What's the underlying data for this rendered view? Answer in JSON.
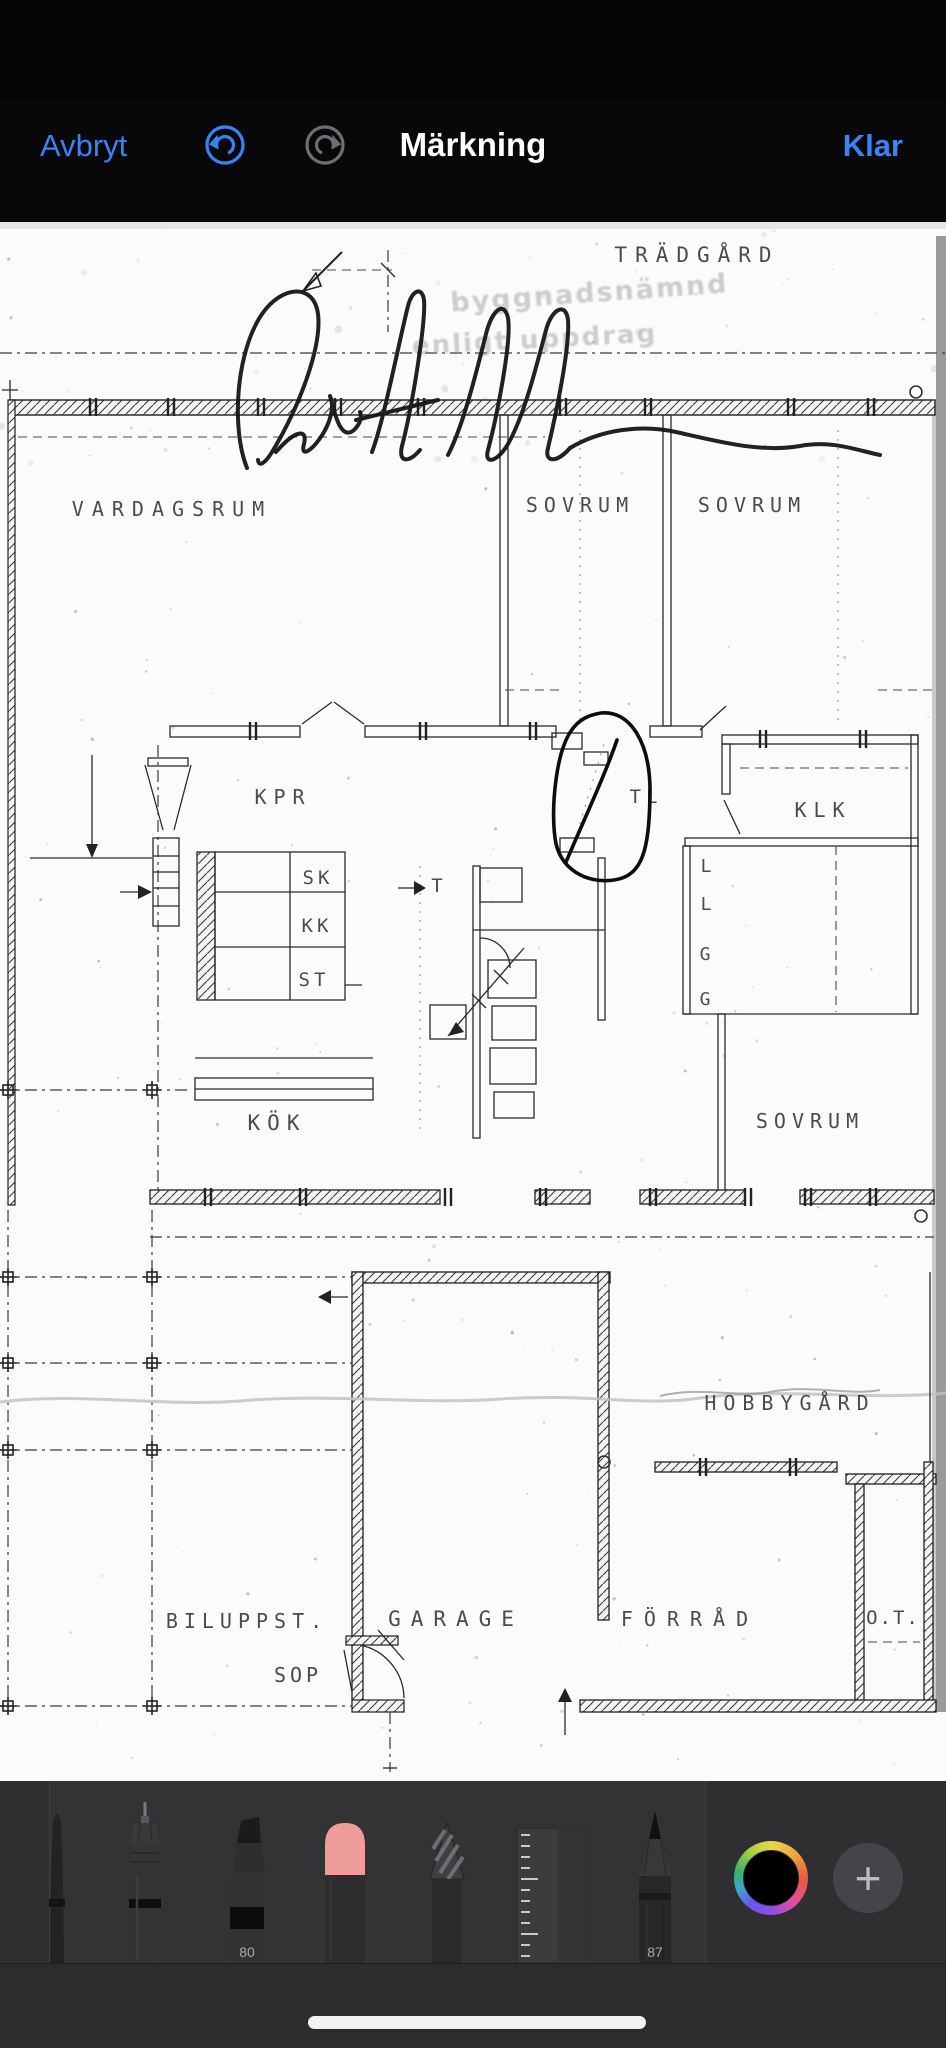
{
  "nav": {
    "cancel_label": "Avbryt",
    "title": "Märkning",
    "done_label": "Klar",
    "accent_color": "#3b82f7",
    "redo_disabled_color": "#6e6e73"
  },
  "plan": {
    "labels": {
      "tradgard": "TRÄDGÅRD",
      "stamp_line1": "byggnadsnämnd",
      "stamp_line2": "enligt uppdrag",
      "vardagsrum": "VARDAGSRUM",
      "sovrum_1": "SOVRUM",
      "sovrum_2": "SOVRUM",
      "kpr": "KPR",
      "tl": "TL",
      "klk": "KLK",
      "sk": "SK",
      "kk": "KK",
      "st": "ST",
      "t": "T",
      "l1": "L",
      "l2": "L",
      "g1": "G",
      "g2": "G",
      "kok": "KÖK",
      "sovrum_3": "SOVRUM",
      "hobbygard": "HOBBYGÅRD",
      "biluppst": "BILUPPST.",
      "garage": "GARAGE",
      "forrad": "FÖRRÅD",
      "ot": "O.T.",
      "sop": "SOP"
    },
    "annotation": "hand-drawn pen circle around wall detail near TL"
  },
  "toolbar": {
    "tools": [
      {
        "name": "fine-brush"
      },
      {
        "name": "fineliner-pen",
        "selected": true
      },
      {
        "name": "chisel-marker",
        "size_label": "80"
      },
      {
        "name": "eraser"
      },
      {
        "name": "lasso-pencil"
      },
      {
        "name": "ruler"
      },
      {
        "name": "pencil",
        "size_label": "87"
      }
    ],
    "selected_color": "#000000"
  }
}
